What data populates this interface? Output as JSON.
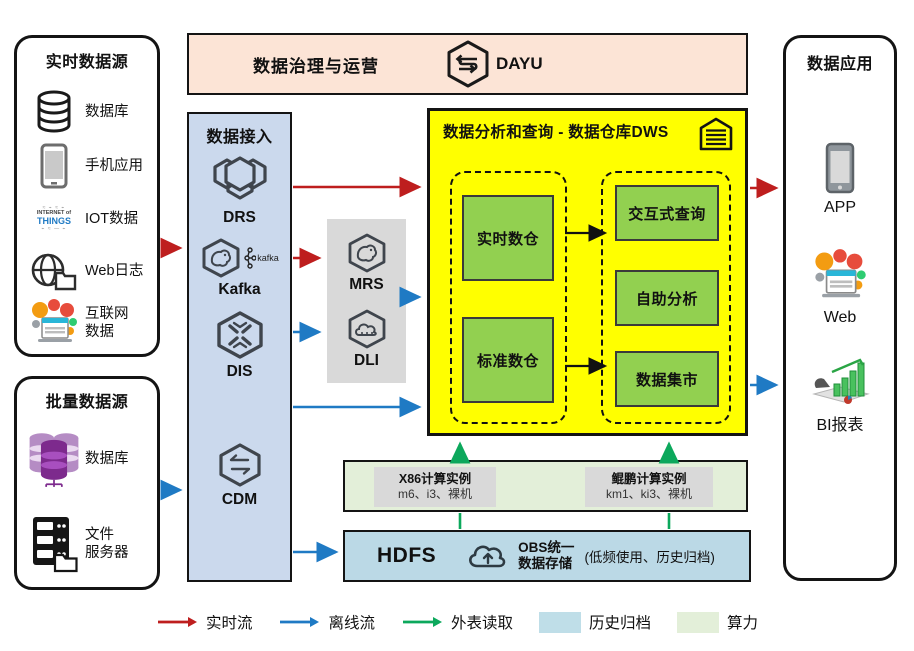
{
  "palette": {
    "realtime_flow": "#BE1E1E",
    "offline_flow": "#1F7AC4",
    "external_read": "#0CA85C",
    "history_archive": "#BFDEE8",
    "compute_power": "#E3EFD9",
    "warehouse_bg": "#FFFF00",
    "warehouse_module": "#92D050",
    "access_bg": "#CBD9ED",
    "governance_bg": "#FCE4D6",
    "service_gray": "#D9D9D9",
    "storage_bg": "#BBD9E6"
  },
  "realtime_sources": {
    "title": "实时数据源",
    "items": [
      {
        "icon": "database-icon",
        "label": "数据库"
      },
      {
        "icon": "phone-icon",
        "label": "手机应用"
      },
      {
        "icon": "iot-icon",
        "label": "IOT数据"
      },
      {
        "icon": "web-log-icon",
        "label": "Web日志"
      },
      {
        "icon": "internet-icon",
        "label": "互联网\n数据"
      }
    ],
    "iot_icon_text": {
      "line1": "INTERNET of",
      "line2": "THINGS"
    }
  },
  "batch_sources": {
    "title": "批量数据源",
    "items": [
      {
        "icon": "purple-database-icon",
        "label": "数据库"
      },
      {
        "icon": "file-server-icon",
        "label": "文件\n服务器"
      }
    ]
  },
  "governance": {
    "title": "数据治理与运营",
    "product": "DAYU"
  },
  "data_access": {
    "title": "数据接入",
    "services": [
      "DRS",
      "Kafka",
      "DIS",
      "CDM"
    ],
    "kafka_logo_text": "kafka"
  },
  "processing": {
    "services": [
      "MRS",
      "DLI"
    ]
  },
  "dws": {
    "title": "数据分析和查询 - 数据仓库DWS",
    "left_group": [
      "实时数仓",
      "标准数仓"
    ],
    "right_group": [
      "交互式查询",
      "自助分析",
      "数据集市"
    ]
  },
  "compute": {
    "instances": [
      {
        "name": "X86计算实例",
        "specs": "m6、i3、裸机"
      },
      {
        "name": "鲲鹏计算实例",
        "specs": "km1、ki3、裸机"
      }
    ]
  },
  "storage": {
    "hdfs": "HDFS",
    "obs": "OBS统一\n数据存储",
    "note": "(低频使用、历史归档)"
  },
  "data_apps": {
    "title": "数据应用",
    "items": [
      {
        "icon": "app-phone-icon",
        "label": "APP"
      },
      {
        "icon": "web-icon",
        "label": "Web"
      },
      {
        "icon": "bi-chart-icon",
        "label": "BI报表"
      }
    ]
  },
  "legend": {
    "items": [
      {
        "type": "arrow",
        "color": "#BE1E1E",
        "label": "实时流"
      },
      {
        "type": "arrow",
        "color": "#1F7AC4",
        "label": "离线流"
      },
      {
        "type": "arrow",
        "color": "#0CA85C",
        "label": "外表读取"
      },
      {
        "type": "swatch",
        "color": "#BFDEE8",
        "label": "历史归档"
      },
      {
        "type": "swatch",
        "color": "#E3EFD9",
        "label": "算力"
      }
    ]
  }
}
